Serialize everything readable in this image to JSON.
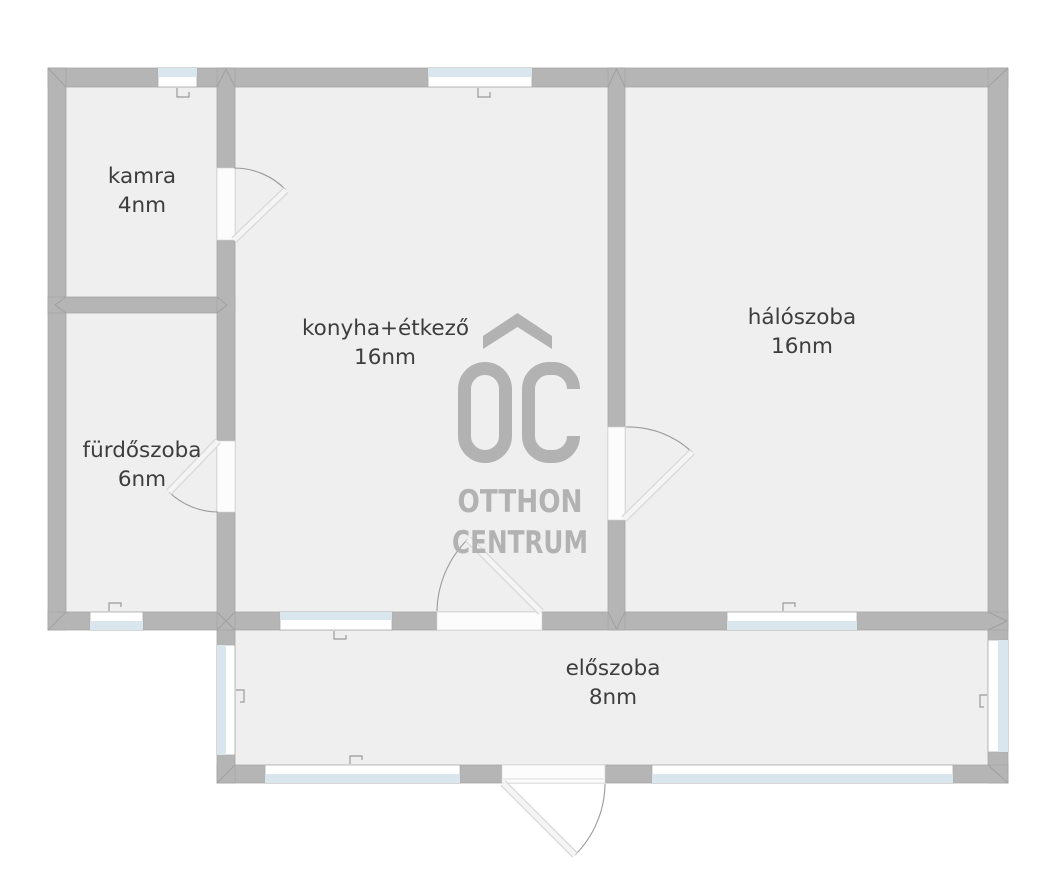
{
  "floorplan": {
    "rooms": [
      {
        "name": "kamra",
        "area": "4nm"
      },
      {
        "name": "fürdőszoba",
        "area": "6nm"
      },
      {
        "name": "konyha+étkező",
        "area": "16nm"
      },
      {
        "name": "hálószoba",
        "area": "16nm"
      },
      {
        "name": "előszoba",
        "area": "8nm"
      }
    ],
    "logo": {
      "monogram": "OC",
      "line1": "OTTHON",
      "line2": "CENTRUM"
    },
    "colors": {
      "wall": "#b5b5b5",
      "floor": "#efefef",
      "window_glass": "#d9e6ee",
      "door_leaf": "#f4f4f4",
      "door_arc": "#9a9a9a",
      "label_text": "#3d3d3d",
      "logo": "#b2b2b2"
    }
  }
}
